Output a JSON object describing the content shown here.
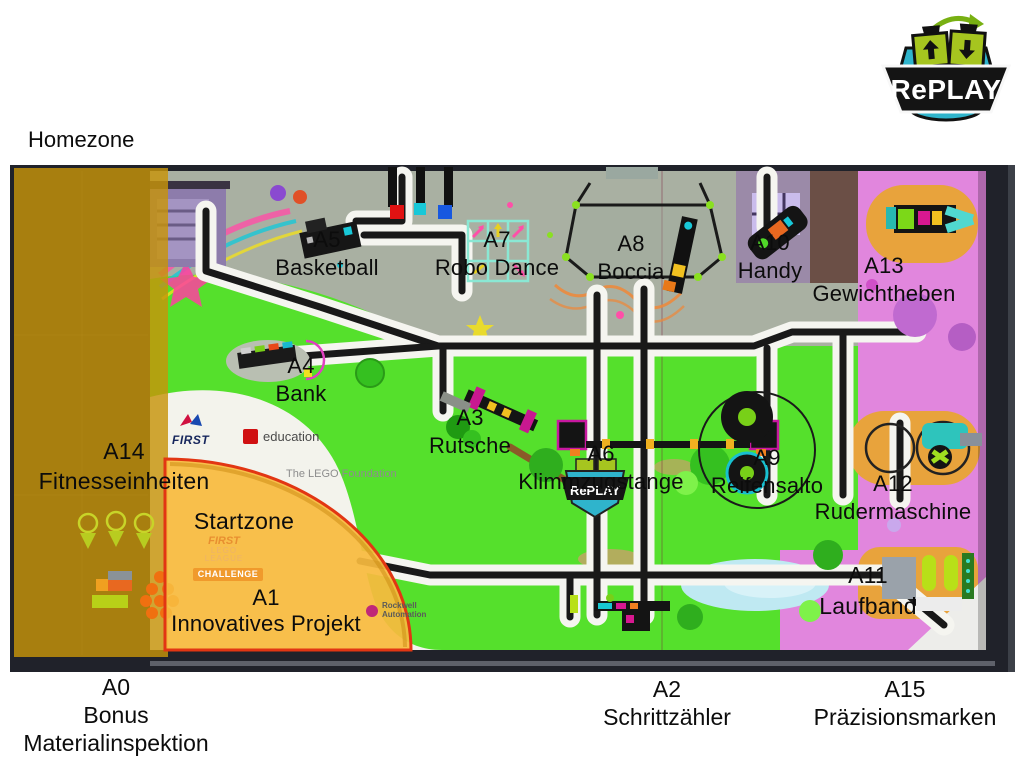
{
  "labels": {
    "homezone": "Homezone",
    "startzone": "Startzone"
  },
  "logo": {
    "wordmark": "RePLAY"
  },
  "missions": {
    "a0": {
      "id": "A0",
      "line1": "Bonus",
      "line2": "Materialinspektion"
    },
    "a1": {
      "id": "A1",
      "name": "Innovatives Projekt"
    },
    "a2": {
      "id": "A2",
      "name": "Schrittzähler"
    },
    "a3": {
      "id": "A3",
      "name": "Rutsche"
    },
    "a4": {
      "id": "A4",
      "name": "Bank"
    },
    "a5": {
      "id": "A5",
      "name": "Basketball"
    },
    "a6": {
      "id": "A6",
      "name": "Klimmzugstange"
    },
    "a7": {
      "id": "A7",
      "name": "Robo Dance"
    },
    "a8": {
      "id": "A8",
      "name": "Boccia"
    },
    "a9": {
      "id": "A9",
      "name": "Reifensalto"
    },
    "a10": {
      "id": "A10",
      "name": "Handy"
    },
    "a11": {
      "id": "A11",
      "name": "Laufband"
    },
    "a12": {
      "id": "A12",
      "name": "Rudermaschine"
    },
    "a13": {
      "id": "A13",
      "name": "Gewichtheben"
    },
    "a14": {
      "id": "A14",
      "name": "Fitnesseinheiten"
    },
    "a15": {
      "id": "A15",
      "name": "Präzisionsmarken"
    }
  },
  "sponsors": {
    "first": "FIRST",
    "lego_education": "education",
    "lego_foundation": "The LEGO Foundation",
    "fll_first": "FIRST",
    "fll_lego": "LEGO",
    "fll_league": "LEAGUE",
    "challenge": "CHALLENGE",
    "rockwell_1": "Rockwell",
    "rockwell_2": "Automation"
  },
  "colors": {
    "homezone_overlay": "#c7940a",
    "startzone_fill": "#f7ba3e",
    "startzone_border": "#e23613",
    "mat_green": "#55e02c",
    "mat_concrete": "#a9b0a2",
    "mat_pink": "#e186dd",
    "mat_orange": "#e8a33c",
    "logo_teal": "#2fb4cc",
    "logo_green": "#a6c51f"
  }
}
